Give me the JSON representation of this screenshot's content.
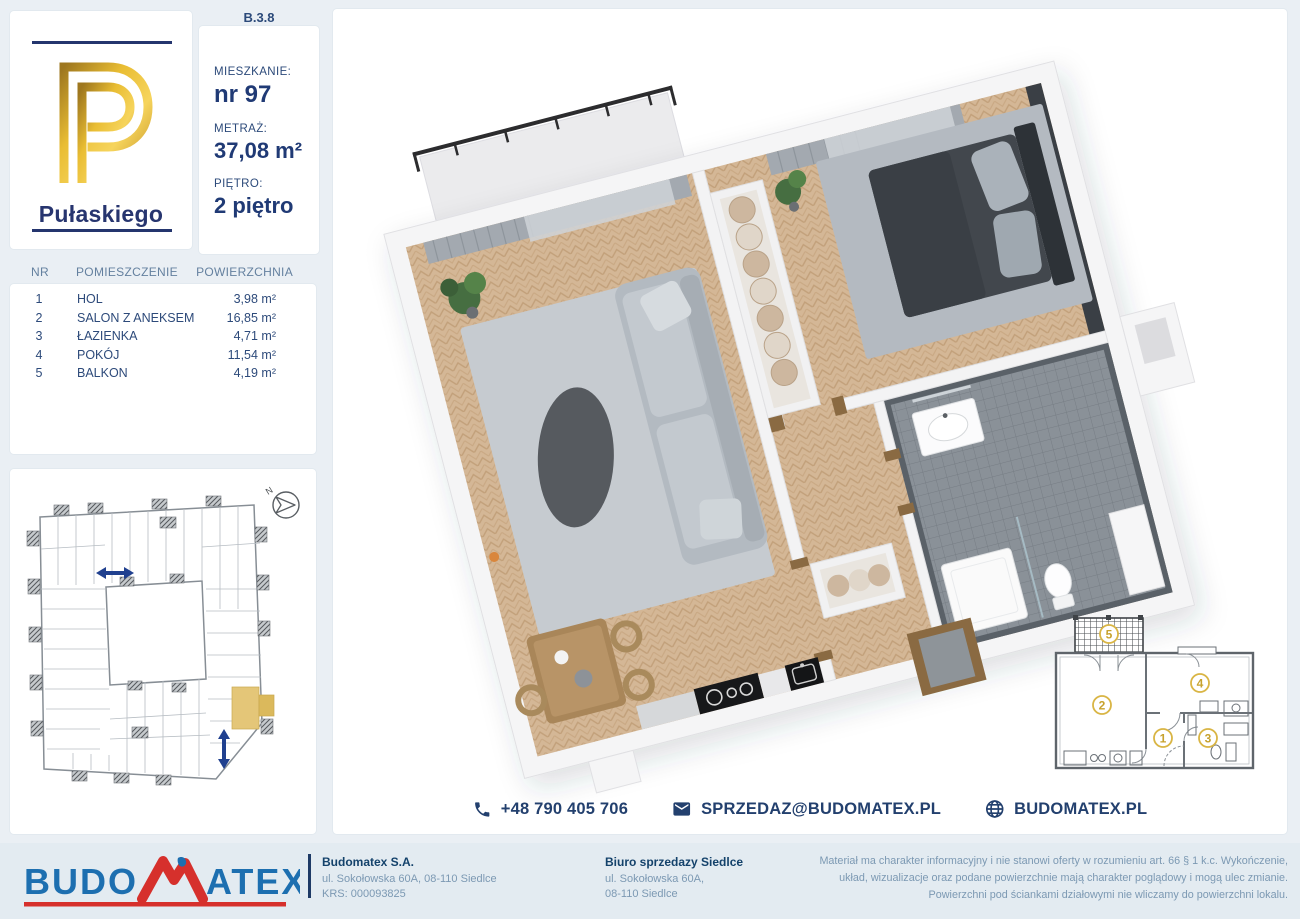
{
  "unit_code": "B.3.8",
  "logo": {
    "project_name": "Pułaskiego"
  },
  "info": {
    "apartment_label": "MIESZKANIE:",
    "apartment_value": "nr 97",
    "area_label": "METRAŻ:",
    "area_value": "37,08 m²",
    "floor_label": "PIĘTRO:",
    "floor_value": "2 piętro"
  },
  "rooms_table": {
    "headers": {
      "nr": "NR",
      "name": "POMIESZCZENIE",
      "area": "POWIERZCHNIA"
    },
    "rows": [
      {
        "nr": "1",
        "name": "HOL",
        "area": "3,98 m²"
      },
      {
        "nr": "2",
        "name": "SALON Z ANEKSEM",
        "area": "16,85 m²"
      },
      {
        "nr": "3",
        "name": "ŁAZIENKA",
        "area": "4,71 m²"
      },
      {
        "nr": "4",
        "name": "POKÓJ",
        "area": "11,54 m²"
      },
      {
        "nr": "5",
        "name": "BALKON",
        "area": "4,19 m²"
      }
    ]
  },
  "site_plan": {
    "north_label": "N"
  },
  "mini_plan": {
    "rooms": {
      "hall": "1",
      "salon": "2",
      "bath": "3",
      "bedroom": "4",
      "balcony": "5"
    }
  },
  "contact": {
    "phone": "+48 790 405 706",
    "email": "SPRZEDAZ@BUDOMATEX.PL",
    "website": "BUDOMATEX.PL"
  },
  "footer": {
    "logo_part1": "BUDO",
    "logo_part2": "ATEX",
    "company": {
      "name": "Budomatex S.A.",
      "address": "ul. Sokołowska 60A, 08-110 Siedlce",
      "krs": "KRS: 000093825"
    },
    "office": {
      "name": "Biuro sprzedazy Siedlce",
      "address_line1": "ul. Sokołowska 60A,",
      "address_line2": "08-110 Siedlce"
    },
    "disclaimer": "Materiał ma charakter informacyjny i nie stanowi oferty w rozumieniu art. 66 § 1 k.c. Wykończenie, układ, wizualizacje oraz podane powierzchnie mają charakter poglądowy i mogą ulec zmianie. Powierzchni pod ściankami działowymi nie wliczamy do powierzchni lokalu."
  },
  "colors": {
    "navy": "#203a75",
    "steel_header": "#64809f",
    "gold_highlight": "#e4c678",
    "gold_circle": "#d9b544",
    "logo_blue": "#1d6fb0",
    "logo_red": "#d6302c"
  }
}
